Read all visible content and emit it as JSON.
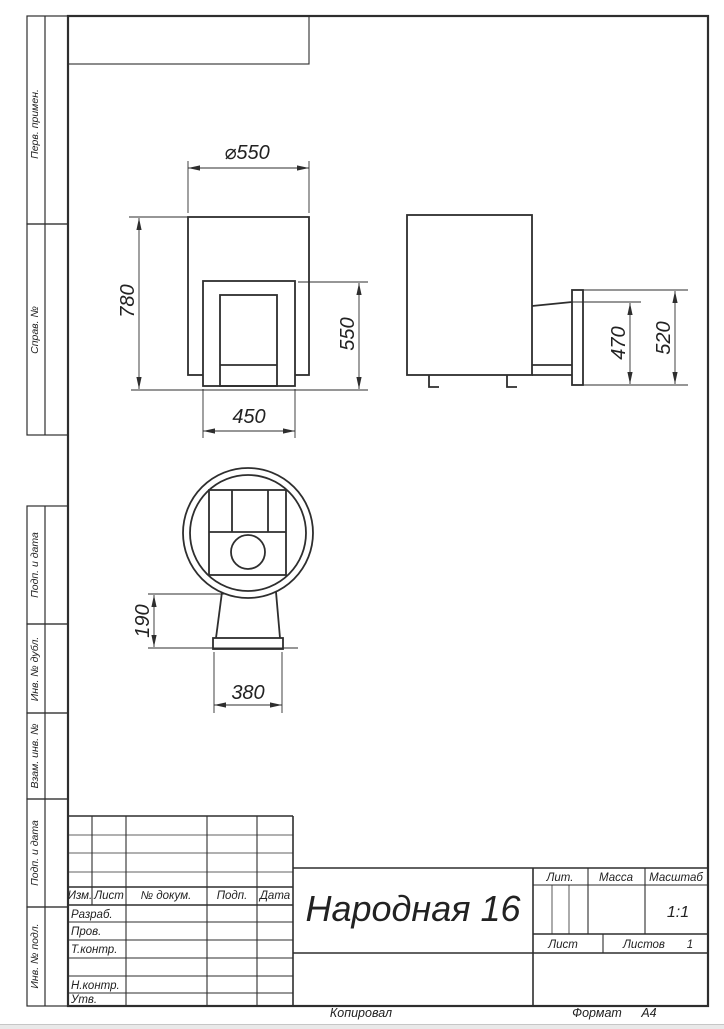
{
  "page": {
    "copied": "Копировал",
    "format_label": "Формат",
    "format_value": "А4"
  },
  "margin_labels": {
    "perv_primen": "Перв. примен.",
    "sprav_no": "Справ. №",
    "podp_i_data_1": "Подп. и дата",
    "inv_no_dubl": "Инв. № дубл.",
    "vzam_inv_no": "Взам. инв. №",
    "podp_i_data_2": "Подп. и дата",
    "inv_no_podl": "Инв. № подл."
  },
  "title_block": {
    "doc_title": "Народная 16",
    "cols": {
      "izm": "Изм.",
      "list": "Лист",
      "doc": "№ докум.",
      "podp": "Подп.",
      "data": "Дата"
    },
    "rows": {
      "razrab": "Разраб.",
      "prov": "Пров.",
      "tkontr": "Т.контр.",
      "nkontr": "Н.контр.",
      "utv": "Утв."
    },
    "lit_label": "Лит.",
    "massa_label": "Масса",
    "masshtab_label": "Масштаб",
    "scale_value": "1:1",
    "list_label": "Лист",
    "listov_label": "Листов",
    "listov_value": "1"
  },
  "dimensions": {
    "front_diameter": "⌀550",
    "front_height": "780",
    "opening_height": "550",
    "opening_width": "450",
    "side_opening_height": "470",
    "side_flange_height": "520",
    "stand_height": "190",
    "stand_width": "380"
  }
}
